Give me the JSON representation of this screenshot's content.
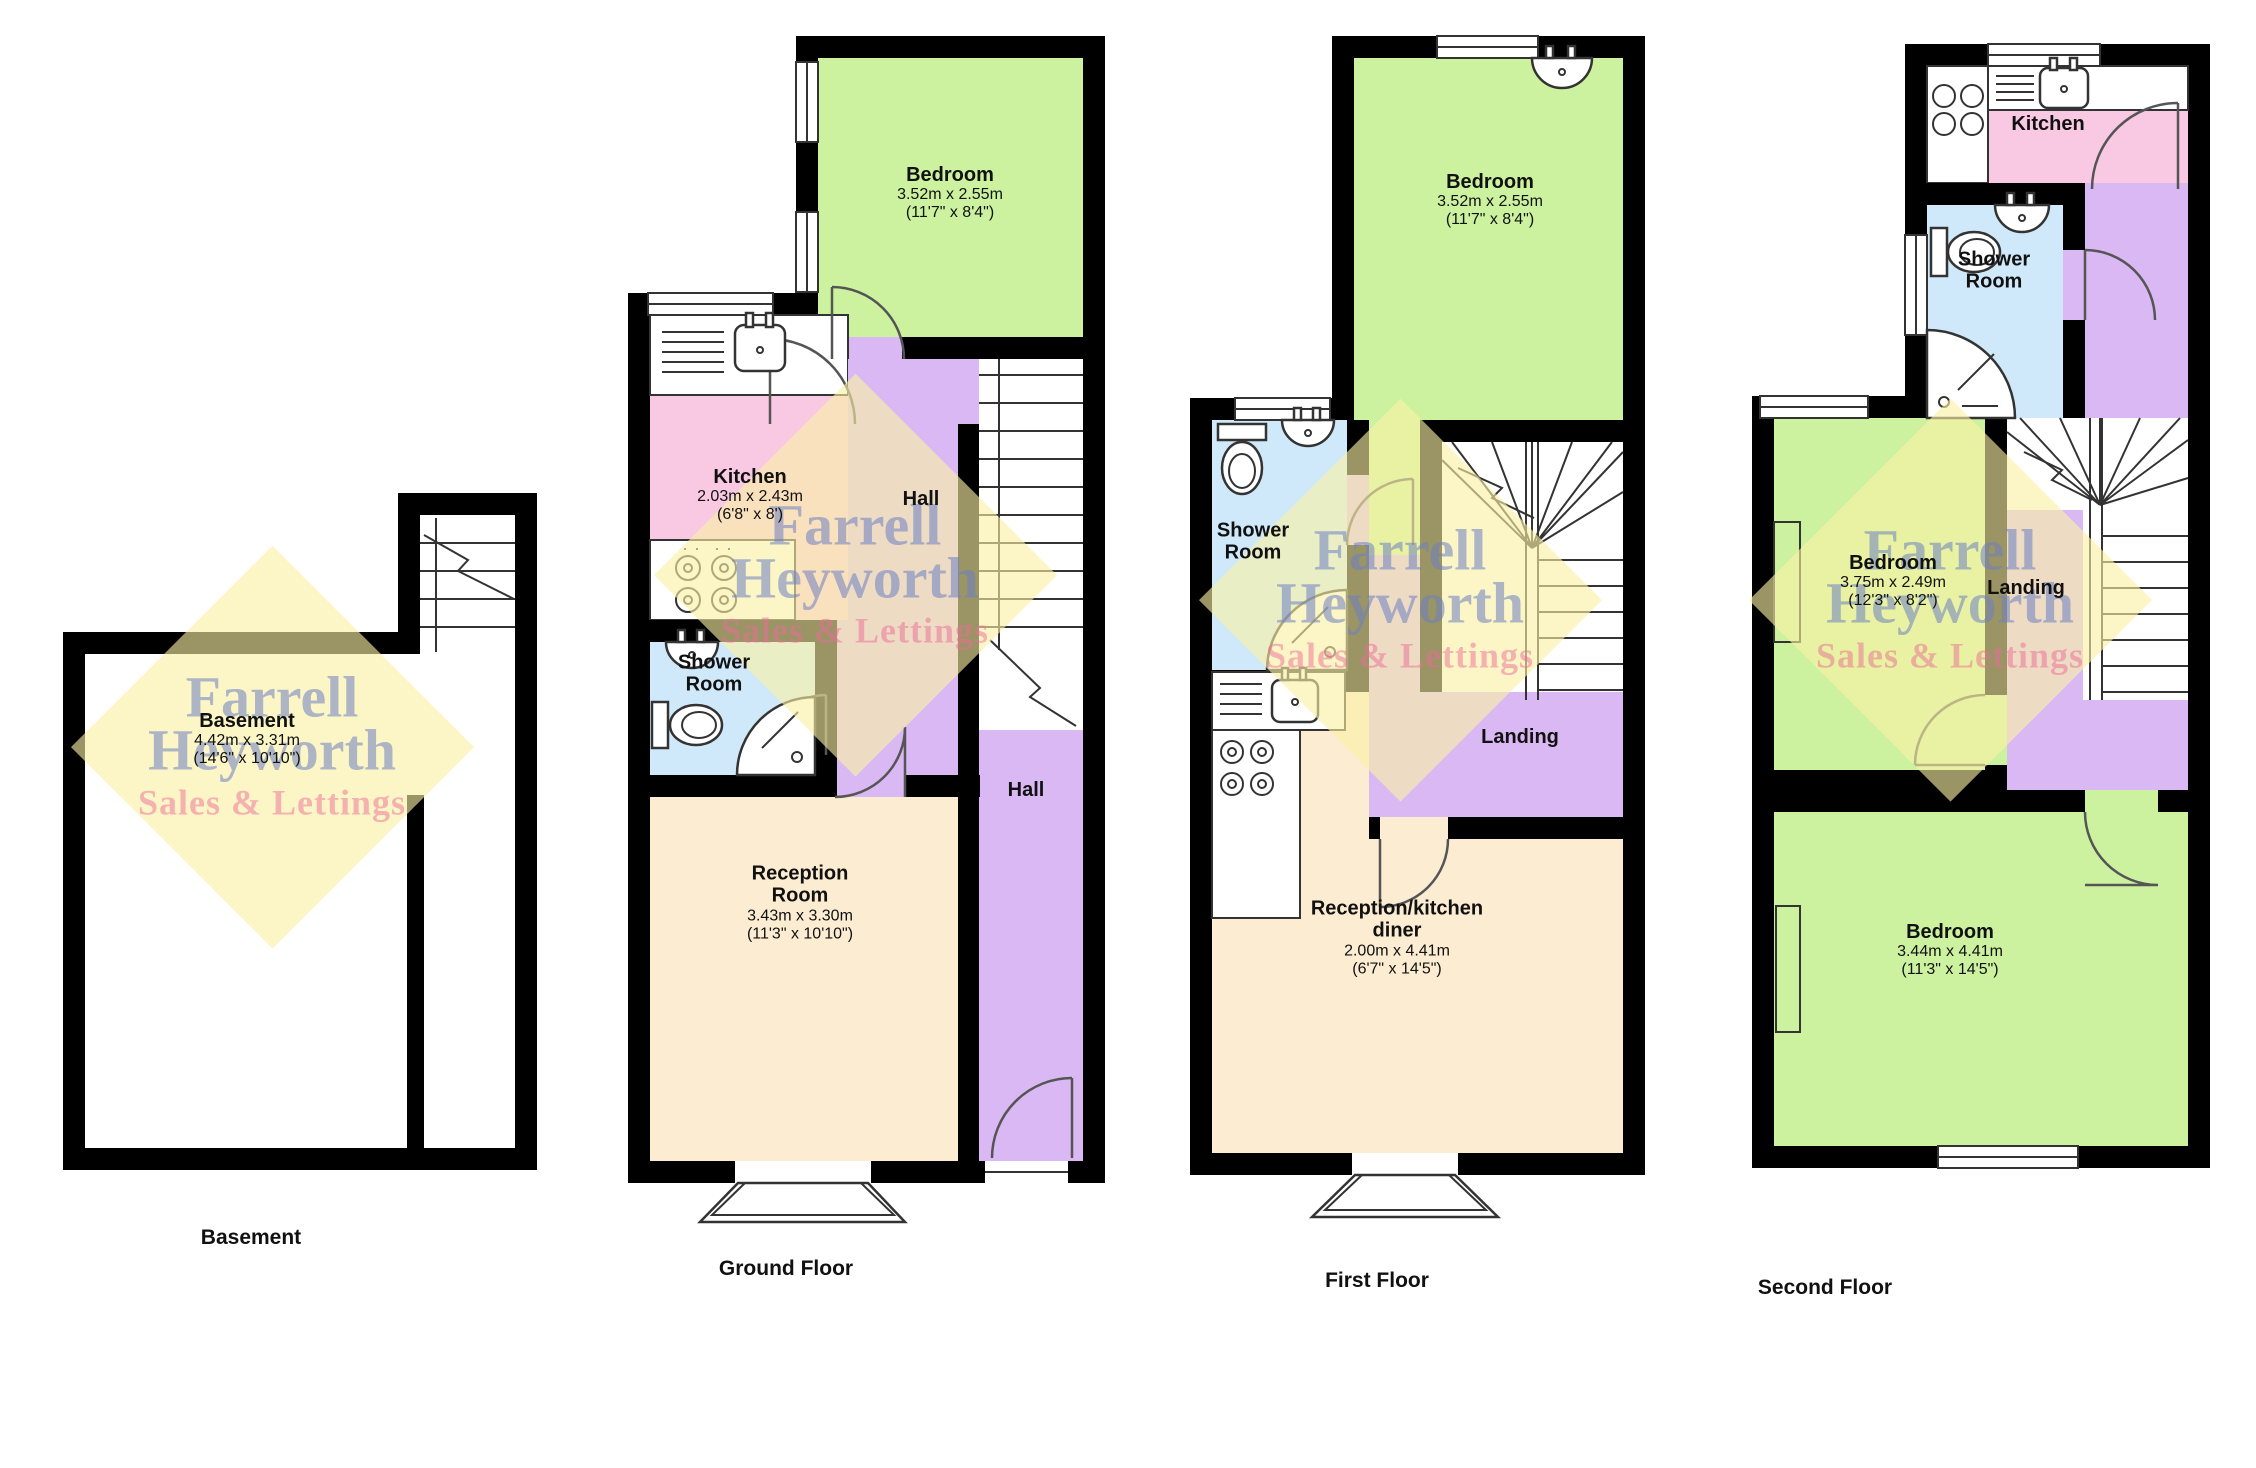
{
  "watermark": {
    "line1": "Farrell",
    "line2": "Heyworth",
    "line3": "Sales & Lettings"
  },
  "colors": {
    "bedroom_green": "#ccf2a0",
    "kitchen_pink": "#f9c9e4",
    "shower_blue": "#cfe9fa",
    "hall_purple": "#d9b8f3",
    "reception_cream": "#fcecd2",
    "wall_black": "#000000",
    "watermark_yellow": "#f8f0a5",
    "watermark_blue": "#6c80c2",
    "watermark_pink": "#ec6c98"
  },
  "floors": {
    "basement": {
      "caption": "Basement",
      "rooms": {
        "basement": {
          "name": "Basement",
          "size_m": "4.42m x 3.31m",
          "size_ft": "(14'6\" x 10'10\")"
        }
      }
    },
    "ground": {
      "caption": "Ground Floor",
      "rooms": {
        "bedroom": {
          "name": "Bedroom",
          "size_m": "3.52m x 2.55m",
          "size_ft": "(11'7\" x 8'4\")"
        },
        "kitchen": {
          "name": "Kitchen",
          "size_m": "2.03m x 2.43m",
          "size_ft": "(6'8\" x 8')"
        },
        "hall_upper": {
          "name": "Hall"
        },
        "shower": {
          "name": "Shower Room"
        },
        "reception": {
          "name": "Reception Room",
          "size_m": "3.43m x 3.30m",
          "size_ft": "(11'3\" x 10'10\")"
        },
        "hall_lower": {
          "name": "Hall"
        }
      }
    },
    "first": {
      "caption": "First Floor",
      "rooms": {
        "bedroom": {
          "name": "Bedroom",
          "size_m": "3.52m x 2.55m",
          "size_ft": "(11'7\" x 8'4\")"
        },
        "shower": {
          "name": "Shower Room"
        },
        "landing": {
          "name": "Landing"
        },
        "reception": {
          "name": "Reception/kitchen diner",
          "size_m": "2.00m x 4.41m",
          "size_ft": "(6'7\" x 14'5\")"
        }
      }
    },
    "second": {
      "caption": "Second Floor",
      "rooms": {
        "kitchen": {
          "name": "Kitchen"
        },
        "shower": {
          "name": "Shower Room"
        },
        "bedroom1": {
          "name": "Bedroom",
          "size_m": "3.75m x 2.49m",
          "size_ft": "(12'3\" x 8'2\")"
        },
        "landing": {
          "name": "Landing"
        },
        "bedroom2": {
          "name": "Bedroom",
          "size_m": "3.44m x 4.41m",
          "size_ft": "(11'3\" x 14'5\")"
        }
      }
    }
  }
}
